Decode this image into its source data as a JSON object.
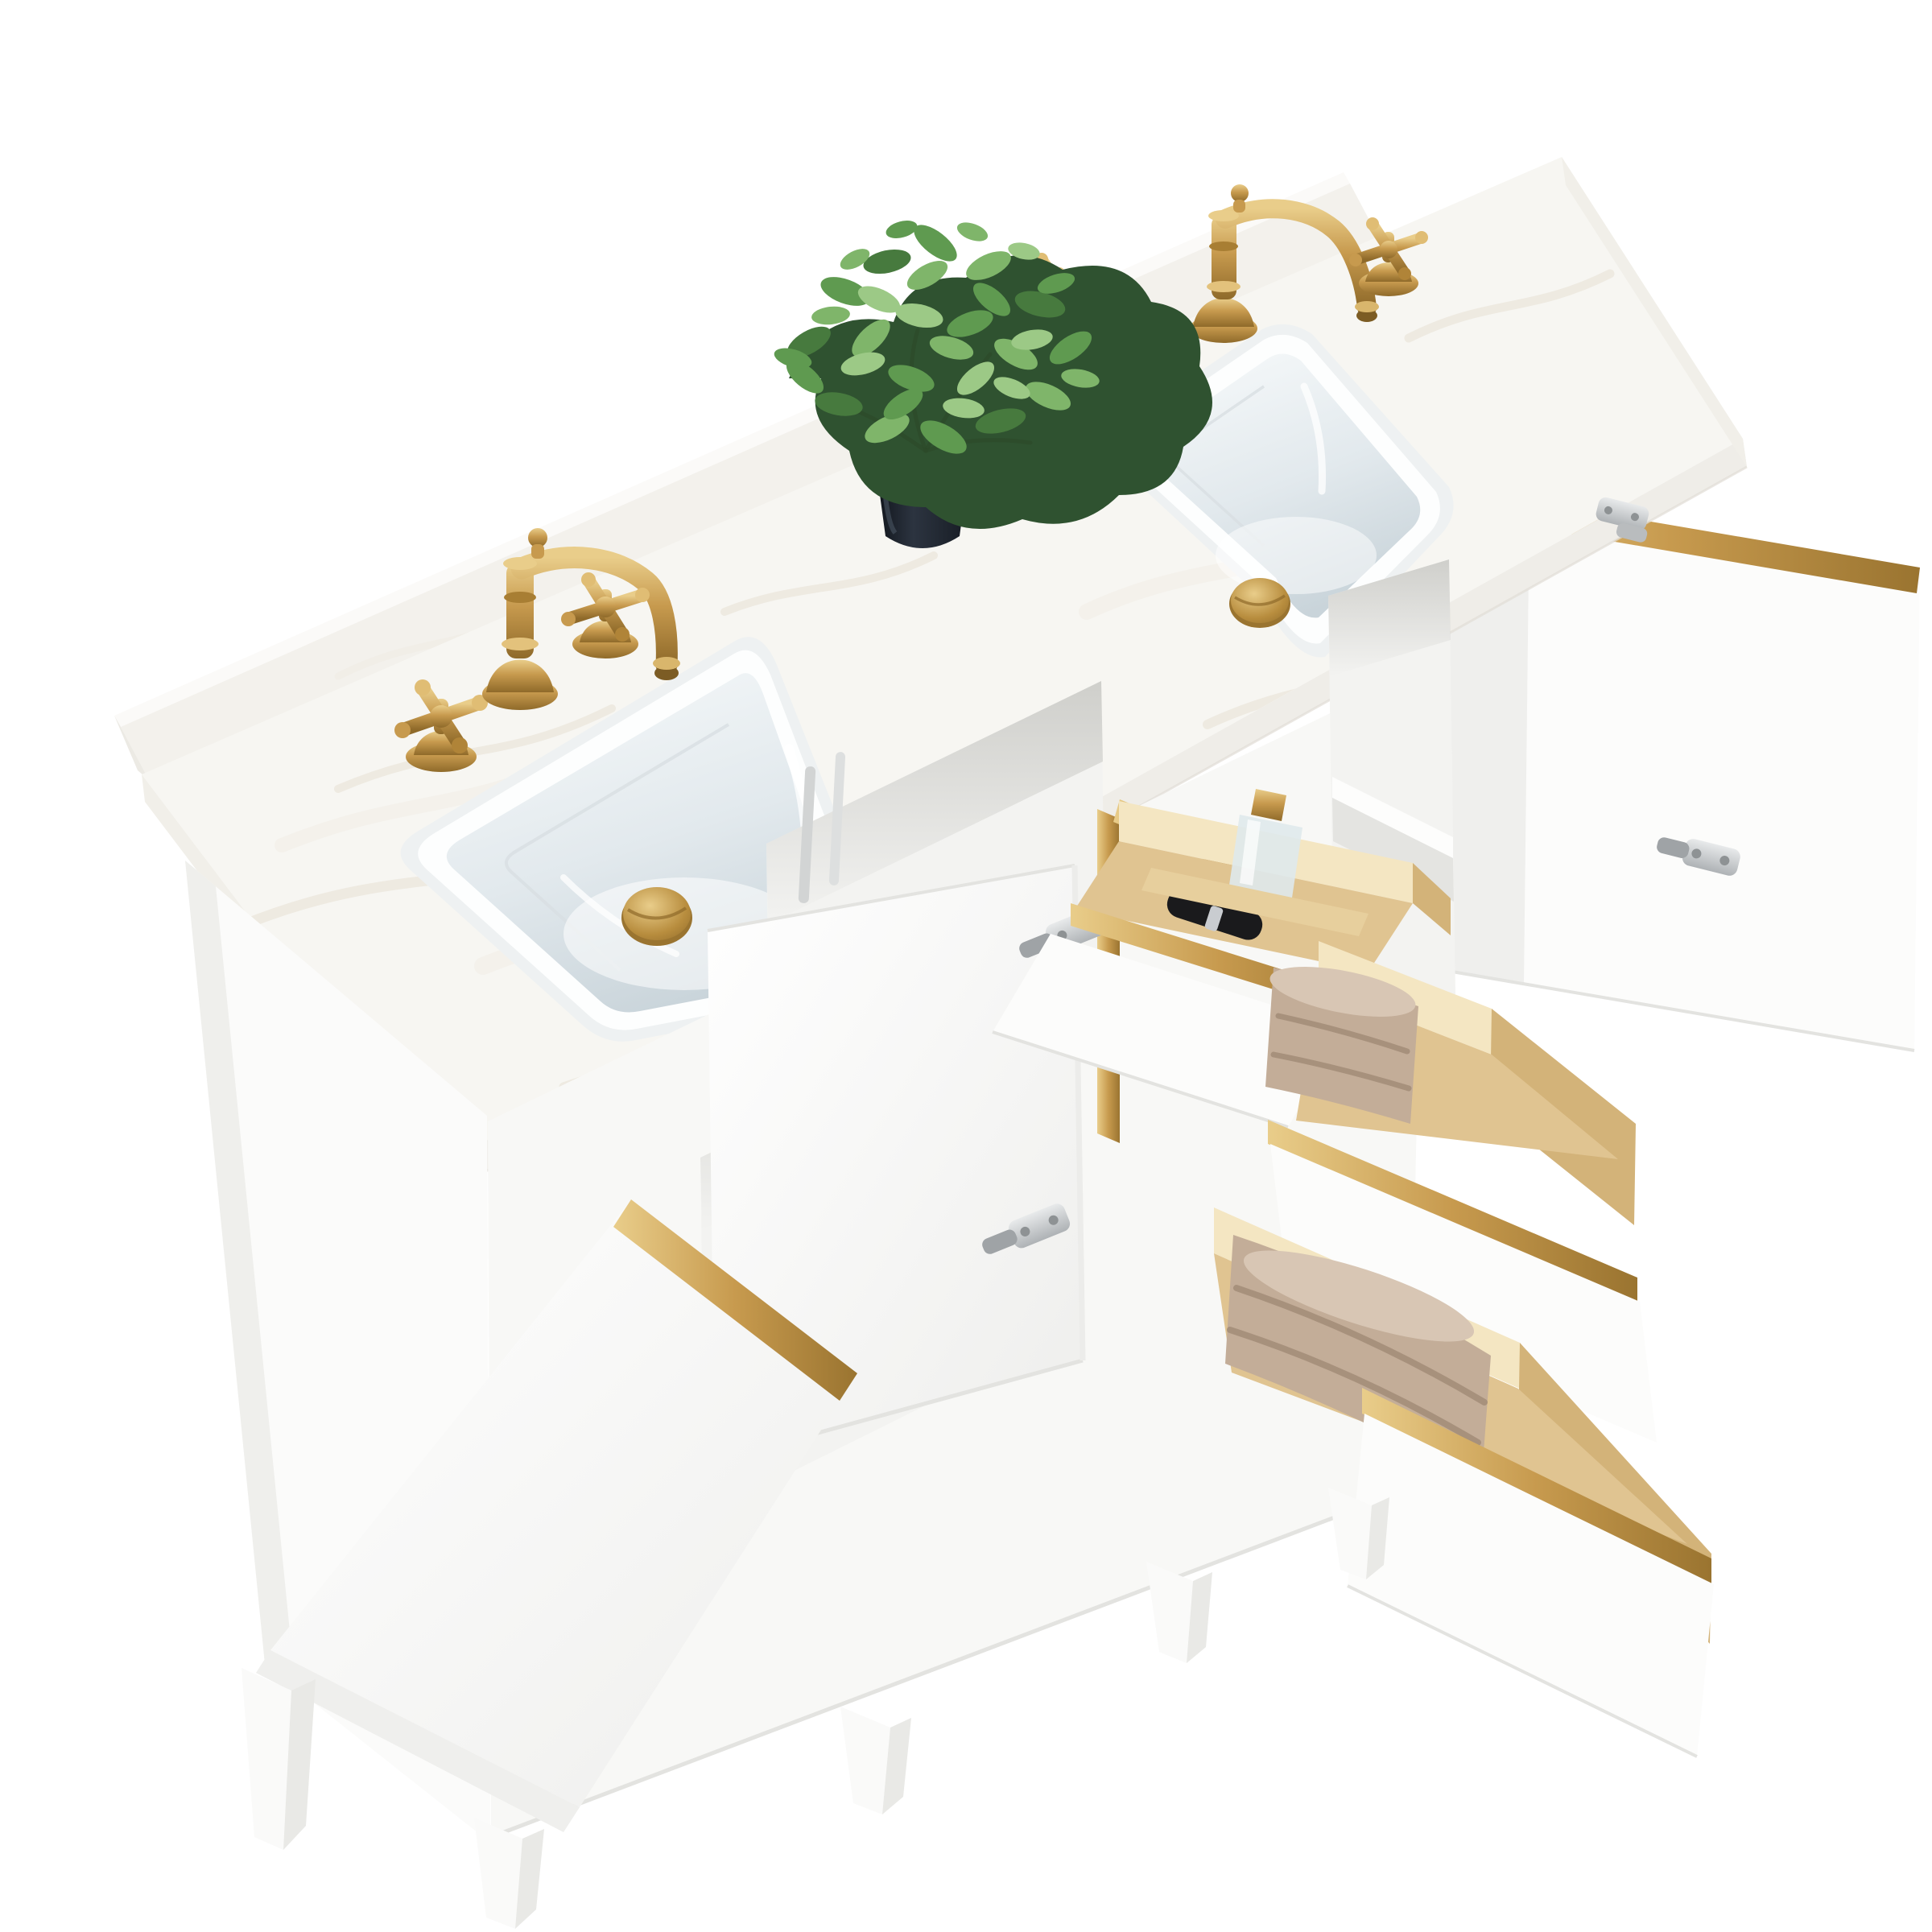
{
  "scene": {
    "type": "product-photograph",
    "subject": "60-inch white double-sink bathroom vanity, three-quarter overhead view",
    "background_style": "pure white cutout, no floor shadows",
    "details": {
      "countertop": "white engineered marble slab with faint warm veining and rear backsplash strip",
      "sinks": "two rectangular white undermount ceramic basins with brushed gold pop-up drains",
      "faucets": "two brushed gold 8-inch widespread faucets, curved spout, two cross handles each",
      "storage_state": "left door open with interior shelf, center door swung open, right door open with gold edge trim, three drawers pulled out",
      "drawer_top": "tilt-out pine organizer tray holding a glass perfume bottle and a black mascara tube",
      "drawer_middle": "pine drawer with folded tan towel, gold trim rail on white front",
      "drawer_bottom": "pine drawer with folded tan towel, gold trim rail on white front",
      "hardware": "satin nickel concealed euro hinges",
      "accent": "brushed gold trim strips along door and drawer edges",
      "decor": "faux green eucalyptus plant in dark navy pot on countertop",
      "legs": "five tapered square white legs"
    }
  },
  "objects": {
    "backsplash": "marble backsplash strip",
    "countertop": "marble countertop slab",
    "left_sink": "left undermount sink",
    "right_sink": "right undermount sink",
    "left_drain": "left gold pop-up drain",
    "right_drain": "right gold pop-up drain",
    "left_faucet": "left gold widespread faucet",
    "right_faucet": "right gold widespread faucet",
    "plant": "faux plant in navy pot",
    "cabinet": "white vanity cabinet",
    "left_side_panel": "cabinet left side panel",
    "left_cavity": "open left compartment with shelf",
    "center_cavity": "open center compartment with supply lines",
    "right_cavity": "open right compartment with shelf",
    "left_door": "open left cabinet door with gold edge",
    "center_door": "open center cabinet door",
    "right_door": "open right cabinet door with gold edge",
    "organizer_drawer": "tilt-out wooden organizer drawer",
    "middle_drawer": "open middle drawer with towel",
    "bottom_drawer": "open bottom drawer with towel",
    "perfume_bottle": "glass perfume bottle with gold cap",
    "mascara": "black cosmetic tube",
    "hinge": "satin nickel hinge",
    "legs": "tapered vanity legs"
  },
  "palette": {
    "bg": "#ffffff",
    "marble": "#f7f6f2",
    "marble_edge": "#efede8",
    "marble_end": "#f1efe9",
    "splash_front": "#f3f1ec",
    "splash_top": "#fbfaf8",
    "splash_facet": "#eceae4",
    "vein": "#e7e0d3",
    "vein_soft": "#efe9df",
    "sink_rim_shadow": "#eef1f2",
    "sink_rim": "#fdfefe",
    "sink_line": "#d8dee2",
    "gold": "#c79a4e",
    "gold_hi": "#e9cd8a",
    "gold_deep": "#8f6a2a",
    "cab_face": "#f8f8f6",
    "cab_panel": "#fbfbfa",
    "cab_edge": "#e3e3e0",
    "cavity": "#f3f3f1",
    "cavity_dark": "#dddddA",
    "shelf": "#fdfdfc",
    "shelf_shadow": "#e4e4e1",
    "door": "#fcfcfb",
    "door_shade": "#efefed",
    "leg": "#fafaf9",
    "leg_side": "#e9e9e6",
    "pine": "#e7cf9d",
    "pine_light": "#f4e6c2",
    "pine_mid": "#d3b379",
    "pine_floor": "#e0c491",
    "towel": "#c3ad98",
    "towel_hi": "#d8c6b4",
    "towel_shadow": "#a08a75",
    "leaf1": "#2f5230",
    "leaf2": "#477a3e",
    "leaf3": "#5f9a50",
    "leaf4": "#7fb56a",
    "leaf5": "#9cc986",
    "stem": "#2c4a2a",
    "pot_dark": "#171c24",
    "pot": "#242b35",
    "pot_hi": "#4a5563",
    "glass": "#dfe9ec",
    "cosmetic": "#1a1a1c",
    "nickel": "#c7c9cb",
    "nickel_dark": "#8e9294"
  }
}
